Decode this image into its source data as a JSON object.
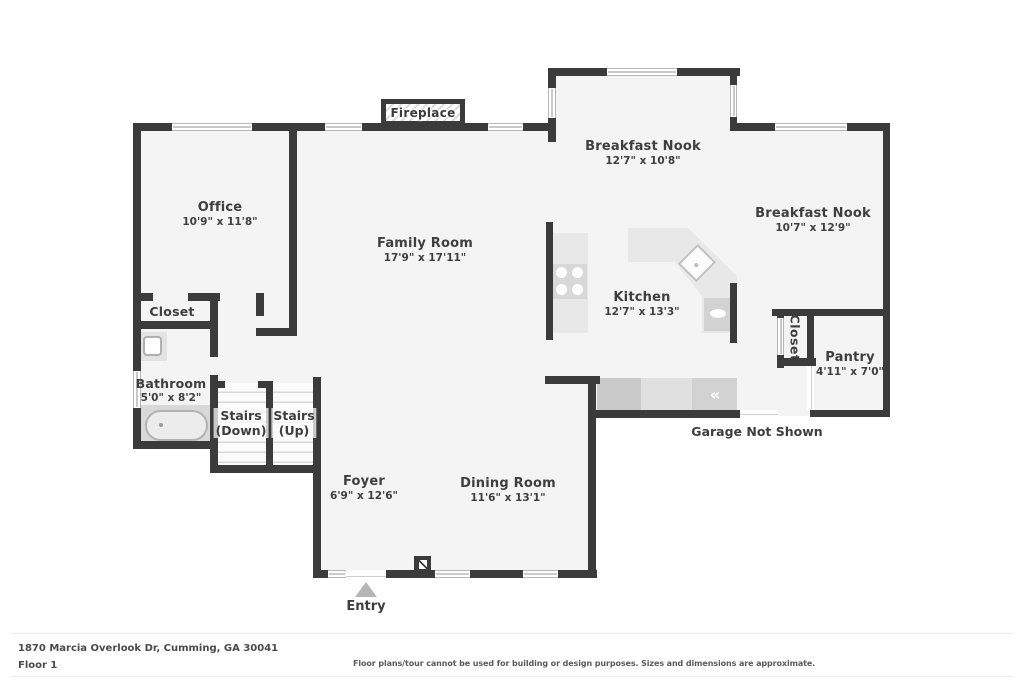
{
  "plan": {
    "rooms": [
      {
        "id": "office",
        "name": "Office",
        "dims": "10'9\" x 11'8\""
      },
      {
        "id": "family-room",
        "name": "Family Room",
        "dims": "17'9\" x 17'11\""
      },
      {
        "id": "breakfast-nook-1",
        "name": "Breakfast Nook",
        "dims": "12'7\" x 10'8\""
      },
      {
        "id": "breakfast-nook-2",
        "name": "Breakfast Nook",
        "dims": "10'7\" x 12'9\""
      },
      {
        "id": "kitchen",
        "name": "Kitchen",
        "dims": "12'7\" x 13'3\""
      },
      {
        "id": "pantry",
        "name": "Pantry",
        "dims": "4'11\" x 7'0\""
      },
      {
        "id": "bathroom",
        "name": "Bathroom",
        "dims": "5'0\" x 8'2\""
      },
      {
        "id": "closet-left",
        "name": "Closet"
      },
      {
        "id": "closet-right",
        "name": "Closet"
      },
      {
        "id": "stairs-down",
        "name": "Stairs",
        "sub": "(Down)"
      },
      {
        "id": "stairs-up",
        "name": "Stairs",
        "sub": "(Up)"
      },
      {
        "id": "foyer",
        "name": "Foyer",
        "dims": "6'9\" x 12'6\""
      },
      {
        "id": "dining-room",
        "name": "Dining Room",
        "dims": "11'6\" x 13'1\""
      }
    ],
    "annotations": {
      "fireplace": "Fireplace",
      "entry": "Entry",
      "garage_note": "Garage Not Shown"
    }
  },
  "icons": {
    "appliance_chevron": "«"
  },
  "colors": {
    "wall": "#3b3b3b",
    "floor": "#f4f4f4",
    "counter": "#e8e8e8",
    "appliance": "#d2d2d2",
    "entry_arrow": "#b5b5b5",
    "label_text": "#3e3e3e"
  },
  "footer": {
    "address": "1870 Marcia Overlook Dr, Cumming, GA 30041",
    "floor_label": "Floor 1",
    "disclaimer": "Floor plans/tour cannot be used for building or design purposes. Sizes and dimensions are approximate."
  }
}
